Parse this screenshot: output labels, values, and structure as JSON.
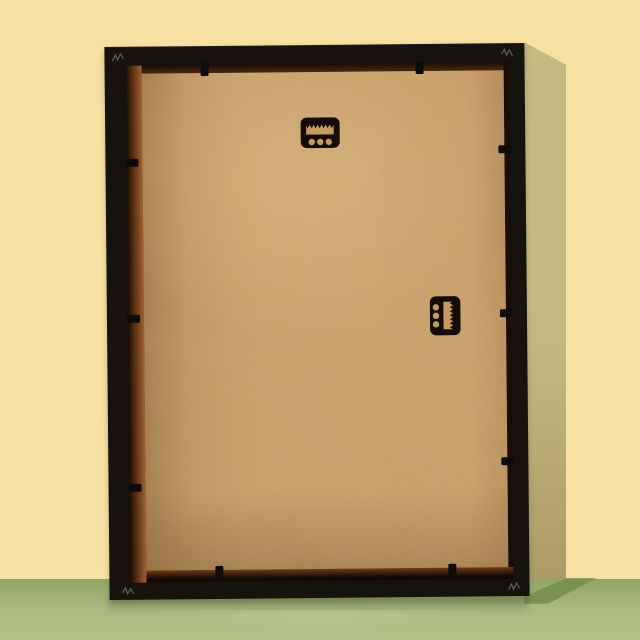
{
  "meta": {
    "description": "Photograph of the back of a black picture frame leaning against a pale yellow wall, standing on a glossy sage-green surface. The tan MDF backing board is held by black retainer tabs, with two black sawtooth hangers (one horizontal near the top, one vertical on the right side)."
  },
  "scene": {
    "wall_label": "pale yellow wall",
    "floor_label": "sage green surface",
    "frame_label": "black picture frame, back view",
    "backing_label": "tan MDF backing board",
    "hardware": {
      "top_hanger": {
        "type": "sawtooth-hanger",
        "orientation": "horizontal",
        "teeth": 7,
        "screw_holes": 3
      },
      "side_hanger": {
        "type": "sawtooth-hanger",
        "orientation": "vertical",
        "teeth": 7,
        "screw_holes": 3
      }
    },
    "retainer_tabs": {
      "count": 10,
      "top": 2,
      "bottom": 2,
      "left": 3,
      "right": 3
    },
    "corner_marks": {
      "count": 4,
      "kind": "v-nail scratch"
    }
  },
  "colors": {
    "wall": "#f6e0a2",
    "wall_shadow": "#c6b881",
    "wall_shadow_deep": "#ab9b66",
    "floor_top": "#8fa565",
    "floor_mid": "#a9b880",
    "floor_bottom": "#b4c28c",
    "floor_shadow": "#7c9154",
    "frame_black": "#16120d",
    "board": "#c79c64",
    "board_light": "#e0ba82",
    "board_dark": "#a97d49",
    "rabbet": "#8a5129",
    "rabbet_dark": "#1f0f05",
    "hanger_black": "#140d07",
    "opening_tan": "#c49a62",
    "tab_black": "#0e0c0a",
    "corner_mark": "#6f675a"
  }
}
